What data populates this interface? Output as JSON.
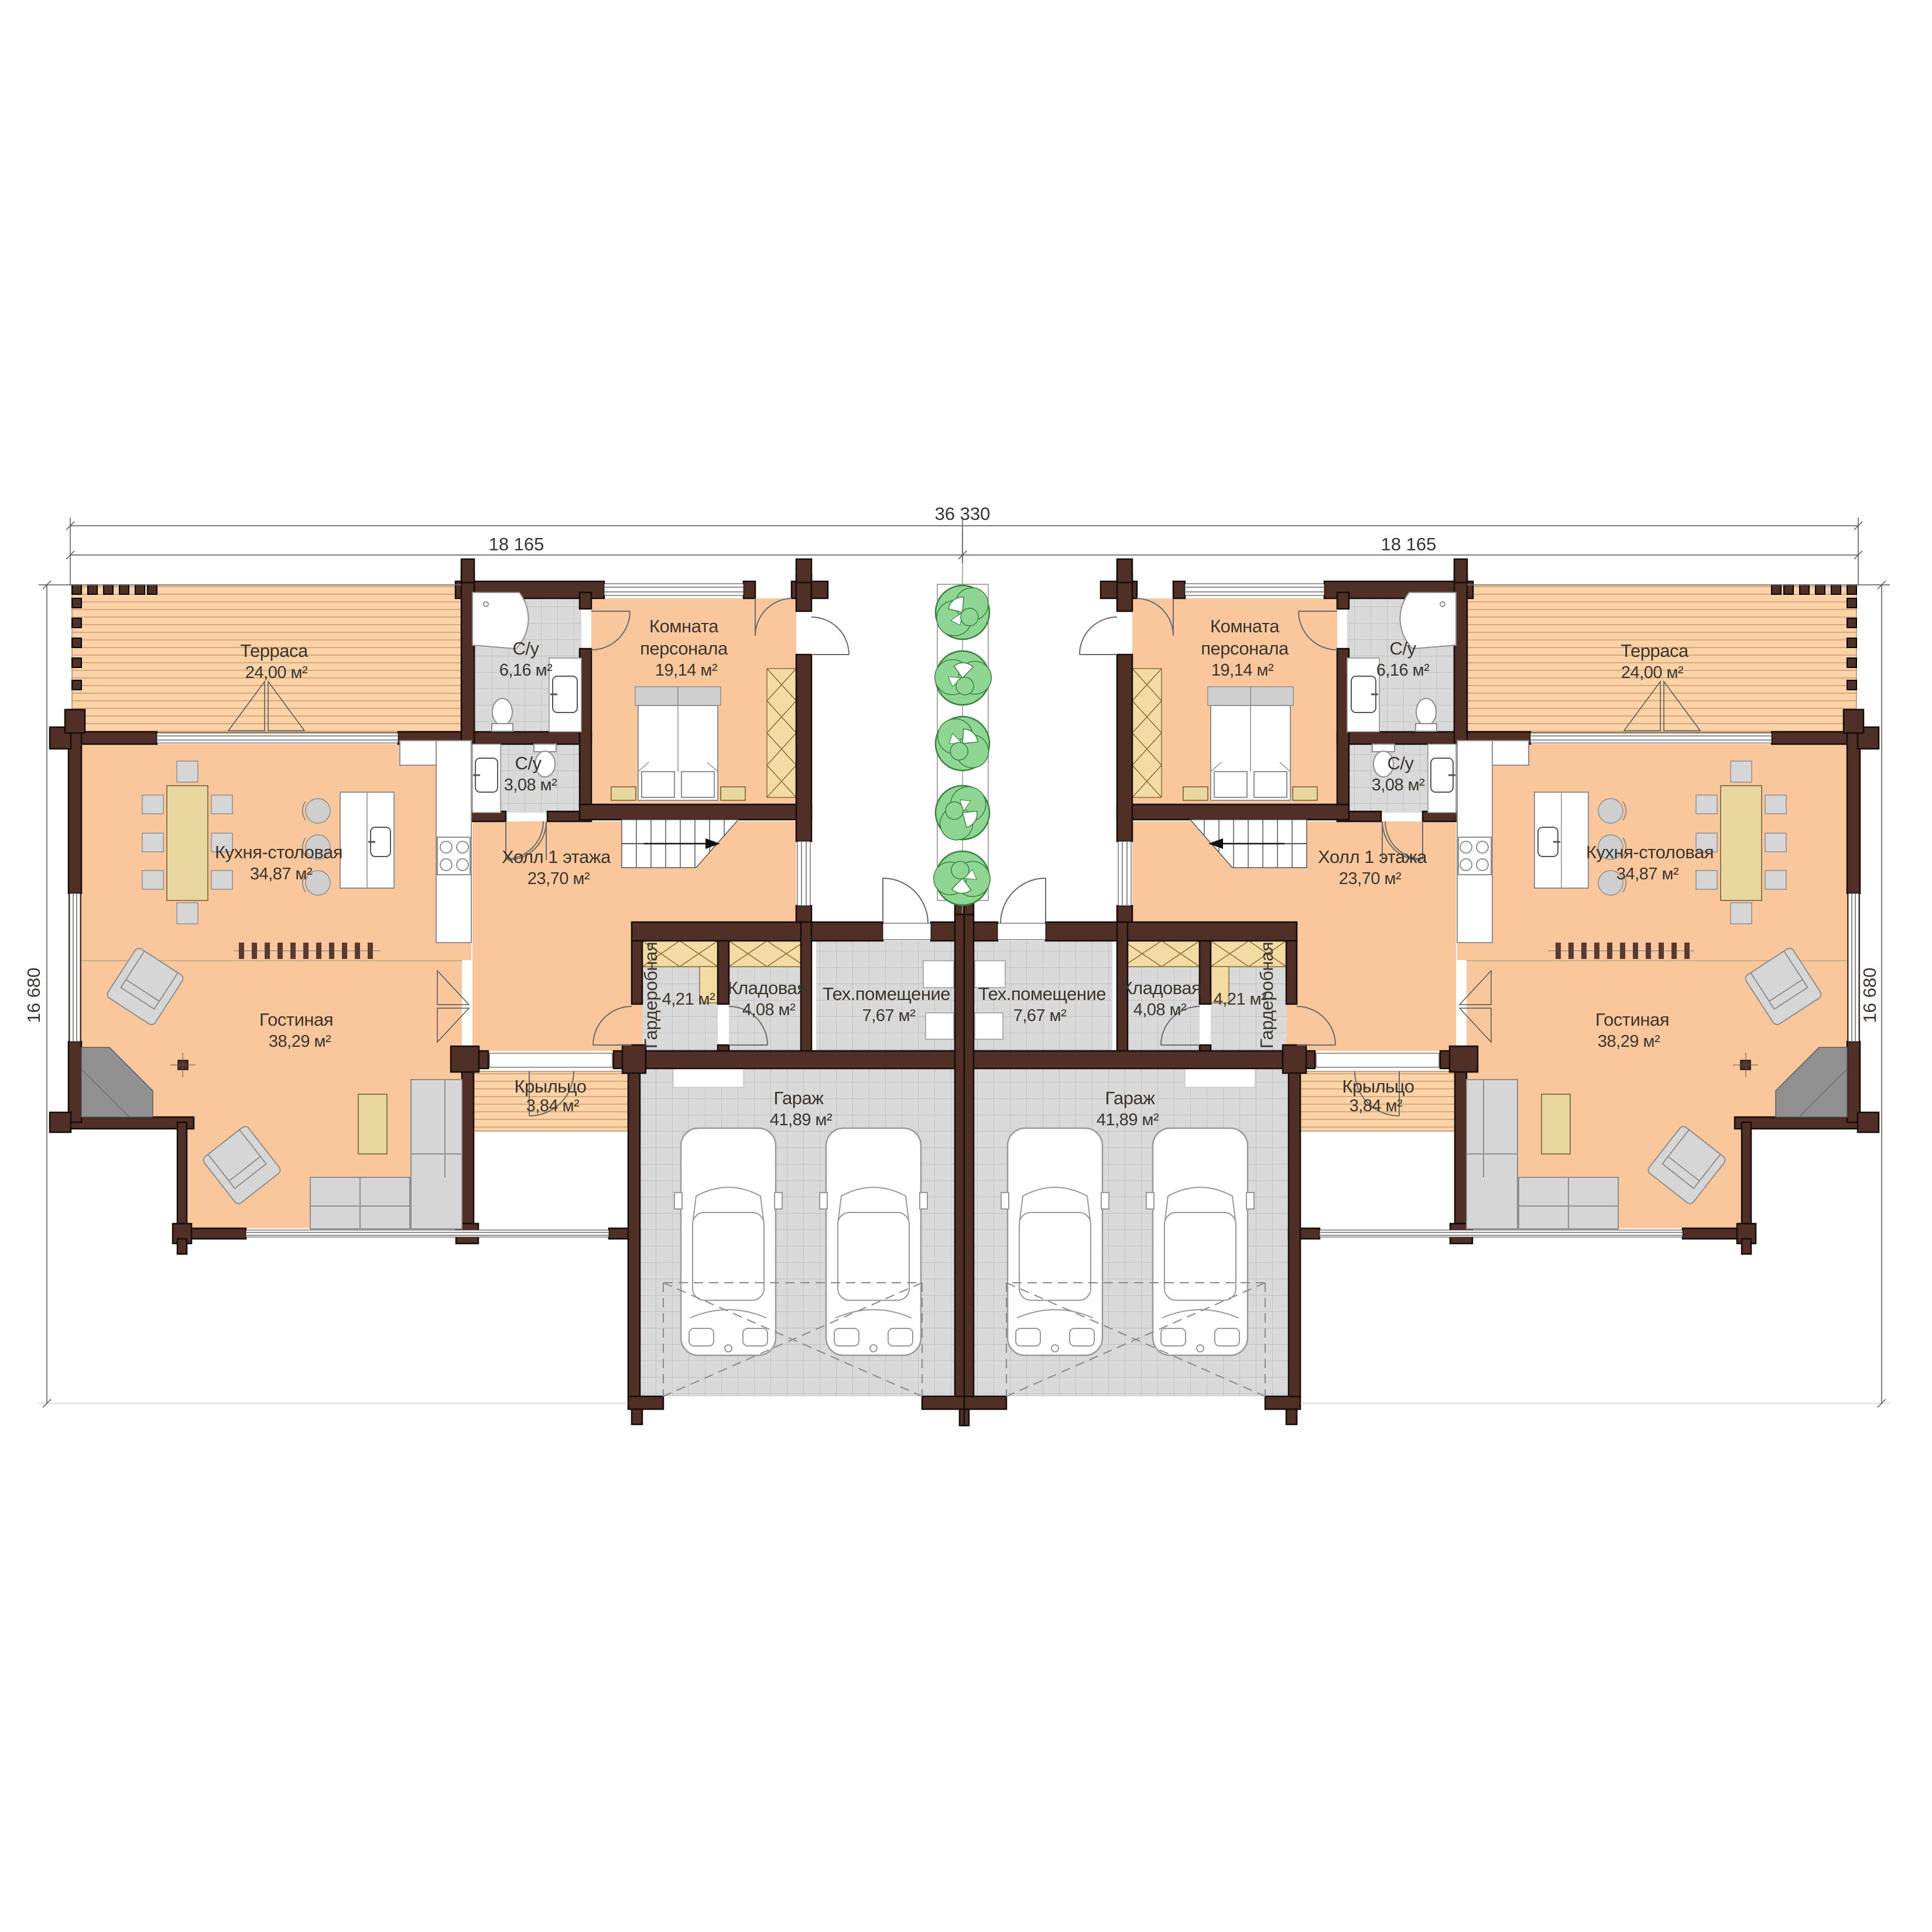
{
  "plan_title": "Duplex first floor plan",
  "dimensions": {
    "top_total": "36 330",
    "top_left_half": "18 165",
    "top_right_half": "18 165",
    "side_left": "16 680",
    "side_right": "16 680"
  },
  "rooms": {
    "terrace": {
      "name": "Терраса",
      "area": "24,00 м²"
    },
    "bath_large": {
      "name": "С/у",
      "area": "6,16 м²"
    },
    "staff": {
      "name_line1": "Комната",
      "name_line2": "персонала",
      "area": "19,14 м²"
    },
    "bath_small": {
      "name": "С/у",
      "area": "3,08 м²"
    },
    "kitchen": {
      "name": "Кухня-столовая",
      "area": "34,87 м²"
    },
    "hall": {
      "name": "Холл 1 этажа",
      "area": "23,70 м²"
    },
    "living": {
      "name": "Гостиная",
      "area": "38,29 м²"
    },
    "wardrobe": {
      "name": "Гардеробная",
      "area": "4,21 м²"
    },
    "storage": {
      "name": "Кладовая",
      "area": "4,08 м²"
    },
    "tech": {
      "name": "Тех.помещение",
      "area": "7,67 м²"
    },
    "porch": {
      "name": "Крыльцо",
      "area": "3,84 м²"
    },
    "garage": {
      "name": "Гараж",
      "area": "41,89 м²"
    }
  },
  "colors": {
    "wall": "#4f2f26",
    "room_fill": "#f9c79b",
    "terrace_fill": "#fbd3a7",
    "tile_fill": "#d9d9d9",
    "cabinet_hatch": "#f3dca4",
    "furniture_yellow": "#e9d79f",
    "furniture_gray": "#d6d6d6",
    "tree_green": "#8fd694"
  }
}
